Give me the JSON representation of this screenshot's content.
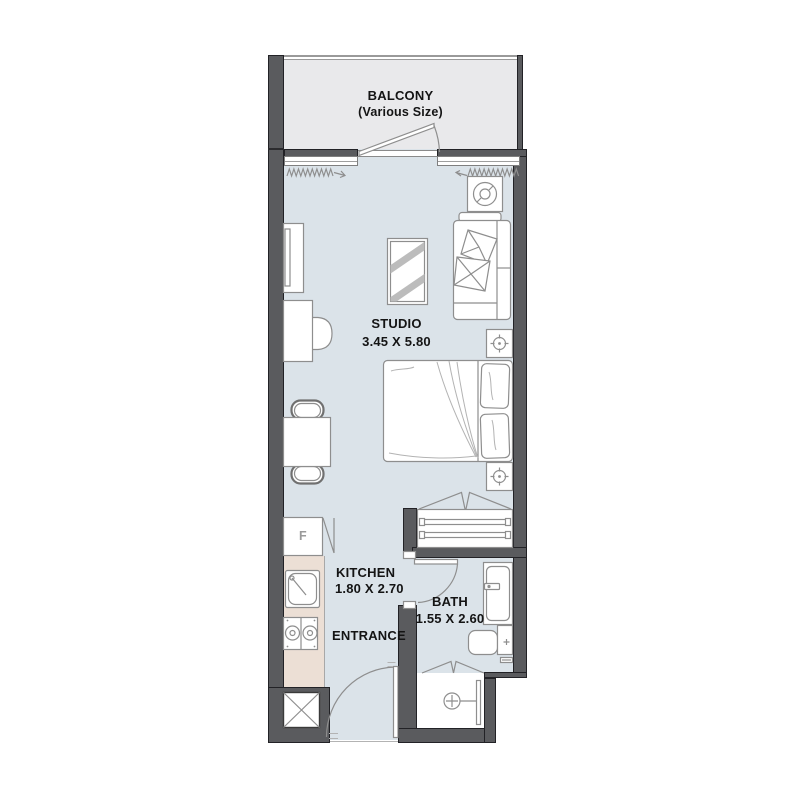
{
  "colors": {
    "wall": "#5a5b5e",
    "wall_outline": "#222226",
    "balcony_floor": "#e9e9eb",
    "room_floor": "#dbe3e9",
    "counter": "#ecdfd5",
    "furniture_line": "#8e8e8e",
    "text": "#141414"
  },
  "rooms": {
    "balcony": {
      "label": "BALCONY",
      "size_note": "(Various Size)"
    },
    "studio": {
      "label": "STUDIO",
      "dimensions": "3.45 X 5.80"
    },
    "kitchen": {
      "label": "KITCHEN",
      "dimensions": "1.80 X 2.70"
    },
    "entrance": {
      "label": "ENTRANCE"
    },
    "bath": {
      "label": "BATH",
      "dimensions": "1.55 X 2.60"
    }
  },
  "appliances": {
    "fridge_label": "F"
  }
}
